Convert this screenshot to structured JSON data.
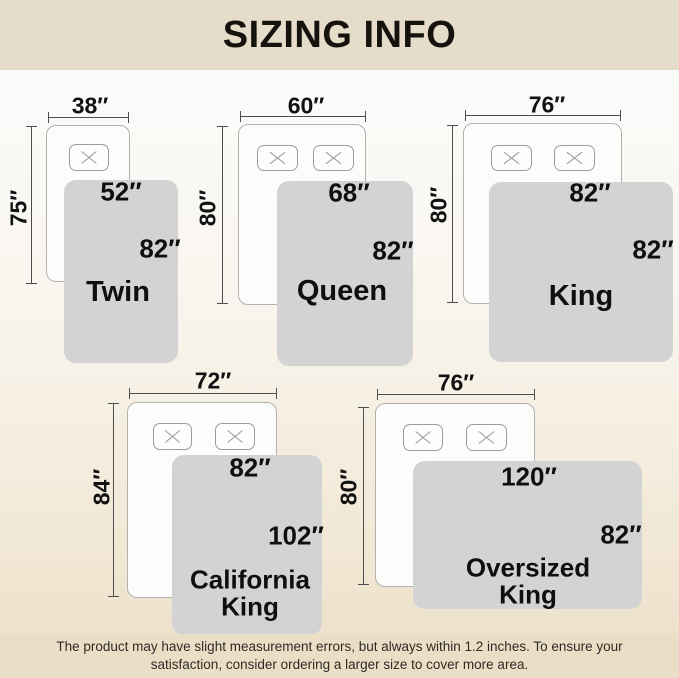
{
  "header": {
    "title": "SIZING INFO"
  },
  "footer": {
    "note": "The product may have slight measurement errors, but always within 1.2 inches. To ensure your satisfaction, consider ordering a larger size to cover more area."
  },
  "colors": {
    "banner_beige": "#e6dcca",
    "footer_beige": "#ebdec6",
    "blanket_gray": "#d3d3d3",
    "bed_white": "#fcfcfb",
    "line_dark": "#4d4d4d",
    "text_black": "#0f0f0f"
  },
  "beds": [
    {
      "id": "twin",
      "name": "Twin",
      "mattress_width_label": "38″",
      "mattress_length_label": "75″",
      "blanket_width_label": "52″",
      "blanket_length_label": "82″",
      "layout": {
        "bed": [
          46,
          125,
          84,
          157
        ],
        "pillows": [
          [
            69,
            144,
            40,
            27
          ]
        ],
        "blanket": [
          64,
          180,
          114,
          183
        ],
        "top_dim": {
          "y": 117,
          "x1": 48,
          "x2": 129,
          "label": [
            90,
            106
          ]
        },
        "left_dim": {
          "x": 31,
          "y1": 126,
          "y2": 284,
          "label": [
            19,
            208
          ]
        },
        "bw_label_c": [
          121,
          192
        ],
        "bl_label_c": [
          160,
          249
        ],
        "name_c": [
          118,
          292
        ],
        "name_size": 29
      }
    },
    {
      "id": "queen",
      "name": "Queen",
      "mattress_width_label": "60″",
      "mattress_length_label": "80″",
      "blanket_width_label": "68″",
      "blanket_length_label": "82″",
      "layout": {
        "bed": [
          238,
          124,
          128,
          181
        ],
        "pillows": [
          [
            257,
            145,
            41,
            26
          ],
          [
            313,
            145,
            41,
            26
          ]
        ],
        "blanket": [
          277,
          181,
          136,
          185
        ],
        "top_dim": {
          "y": 116,
          "x1": 240,
          "x2": 366,
          "label": [
            306,
            106
          ]
        },
        "left_dim": {
          "x": 222,
          "y1": 126,
          "y2": 304,
          "label": [
            208,
            208
          ]
        },
        "bw_label_c": [
          349,
          193
        ],
        "bl_label_c": [
          393,
          251
        ],
        "name_c": [
          342,
          291
        ],
        "name_size": 29
      }
    },
    {
      "id": "king",
      "name": "King",
      "mattress_width_label": "76″",
      "mattress_length_label": "80″",
      "blanket_width_label": "82″",
      "blanket_length_label": "82″",
      "layout": {
        "bed": [
          463,
          123,
          159,
          181
        ],
        "pillows": [
          [
            491,
            145,
            41,
            26
          ],
          [
            554,
            145,
            41,
            26
          ]
        ],
        "blanket": [
          489,
          182,
          184,
          180
        ],
        "top_dim": {
          "y": 115,
          "x1": 465,
          "x2": 621,
          "label": [
            547,
            105
          ]
        },
        "left_dim": {
          "x": 452,
          "y1": 125,
          "y2": 303,
          "label": [
            439,
            205
          ]
        },
        "bw_label_c": [
          590,
          193
        ],
        "bl_label_c": [
          653,
          250
        ],
        "name_c": [
          581,
          296
        ],
        "name_size": 29
      }
    },
    {
      "id": "california-king",
      "name": "California King",
      "mattress_width_label": "72″",
      "mattress_length_label": "84″",
      "blanket_width_label": "82″",
      "blanket_length_label": "102″",
      "layout": {
        "bed": [
          127,
          402,
          150,
          196
        ],
        "pillows": [
          [
            153,
            423,
            39,
            27
          ],
          [
            215,
            423,
            40,
            27
          ]
        ],
        "blanket": [
          172,
          455,
          150,
          180
        ],
        "top_dim": {
          "y": 393,
          "x1": 129,
          "x2": 277,
          "label": [
            213,
            381
          ]
        },
        "left_dim": {
          "x": 113,
          "y1": 403,
          "y2": 597,
          "label": [
            102,
            487
          ]
        },
        "bw_label_c": [
          250,
          468
        ],
        "bl_label_c": [
          296,
          536
        ],
        "name_c": [
          250,
          594
        ],
        "name_size": 26,
        "name_w": 150
      }
    },
    {
      "id": "oversized-king",
      "name": "Oversized King",
      "mattress_width_label": "76″",
      "mattress_length_label": "80″",
      "blanket_width_label": "120″",
      "blanket_length_label": "82″",
      "layout": {
        "bed": [
          375,
          403,
          160,
          184
        ],
        "pillows": [
          [
            403,
            424,
            40,
            27
          ],
          [
            466,
            424,
            41,
            27
          ]
        ],
        "blanket": [
          413,
          461,
          229,
          148
        ],
        "top_dim": {
          "y": 394,
          "x1": 377,
          "x2": 535,
          "label": [
            456,
            383
          ]
        },
        "left_dim": {
          "x": 363,
          "y1": 407,
          "y2": 585,
          "label": [
            349,
            487
          ]
        },
        "bw_label_c": [
          529,
          477
        ],
        "bl_label_c": [
          621,
          535
        ],
        "name_c": [
          528,
          582
        ],
        "name_size": 26,
        "name_w": 160
      }
    }
  ]
}
